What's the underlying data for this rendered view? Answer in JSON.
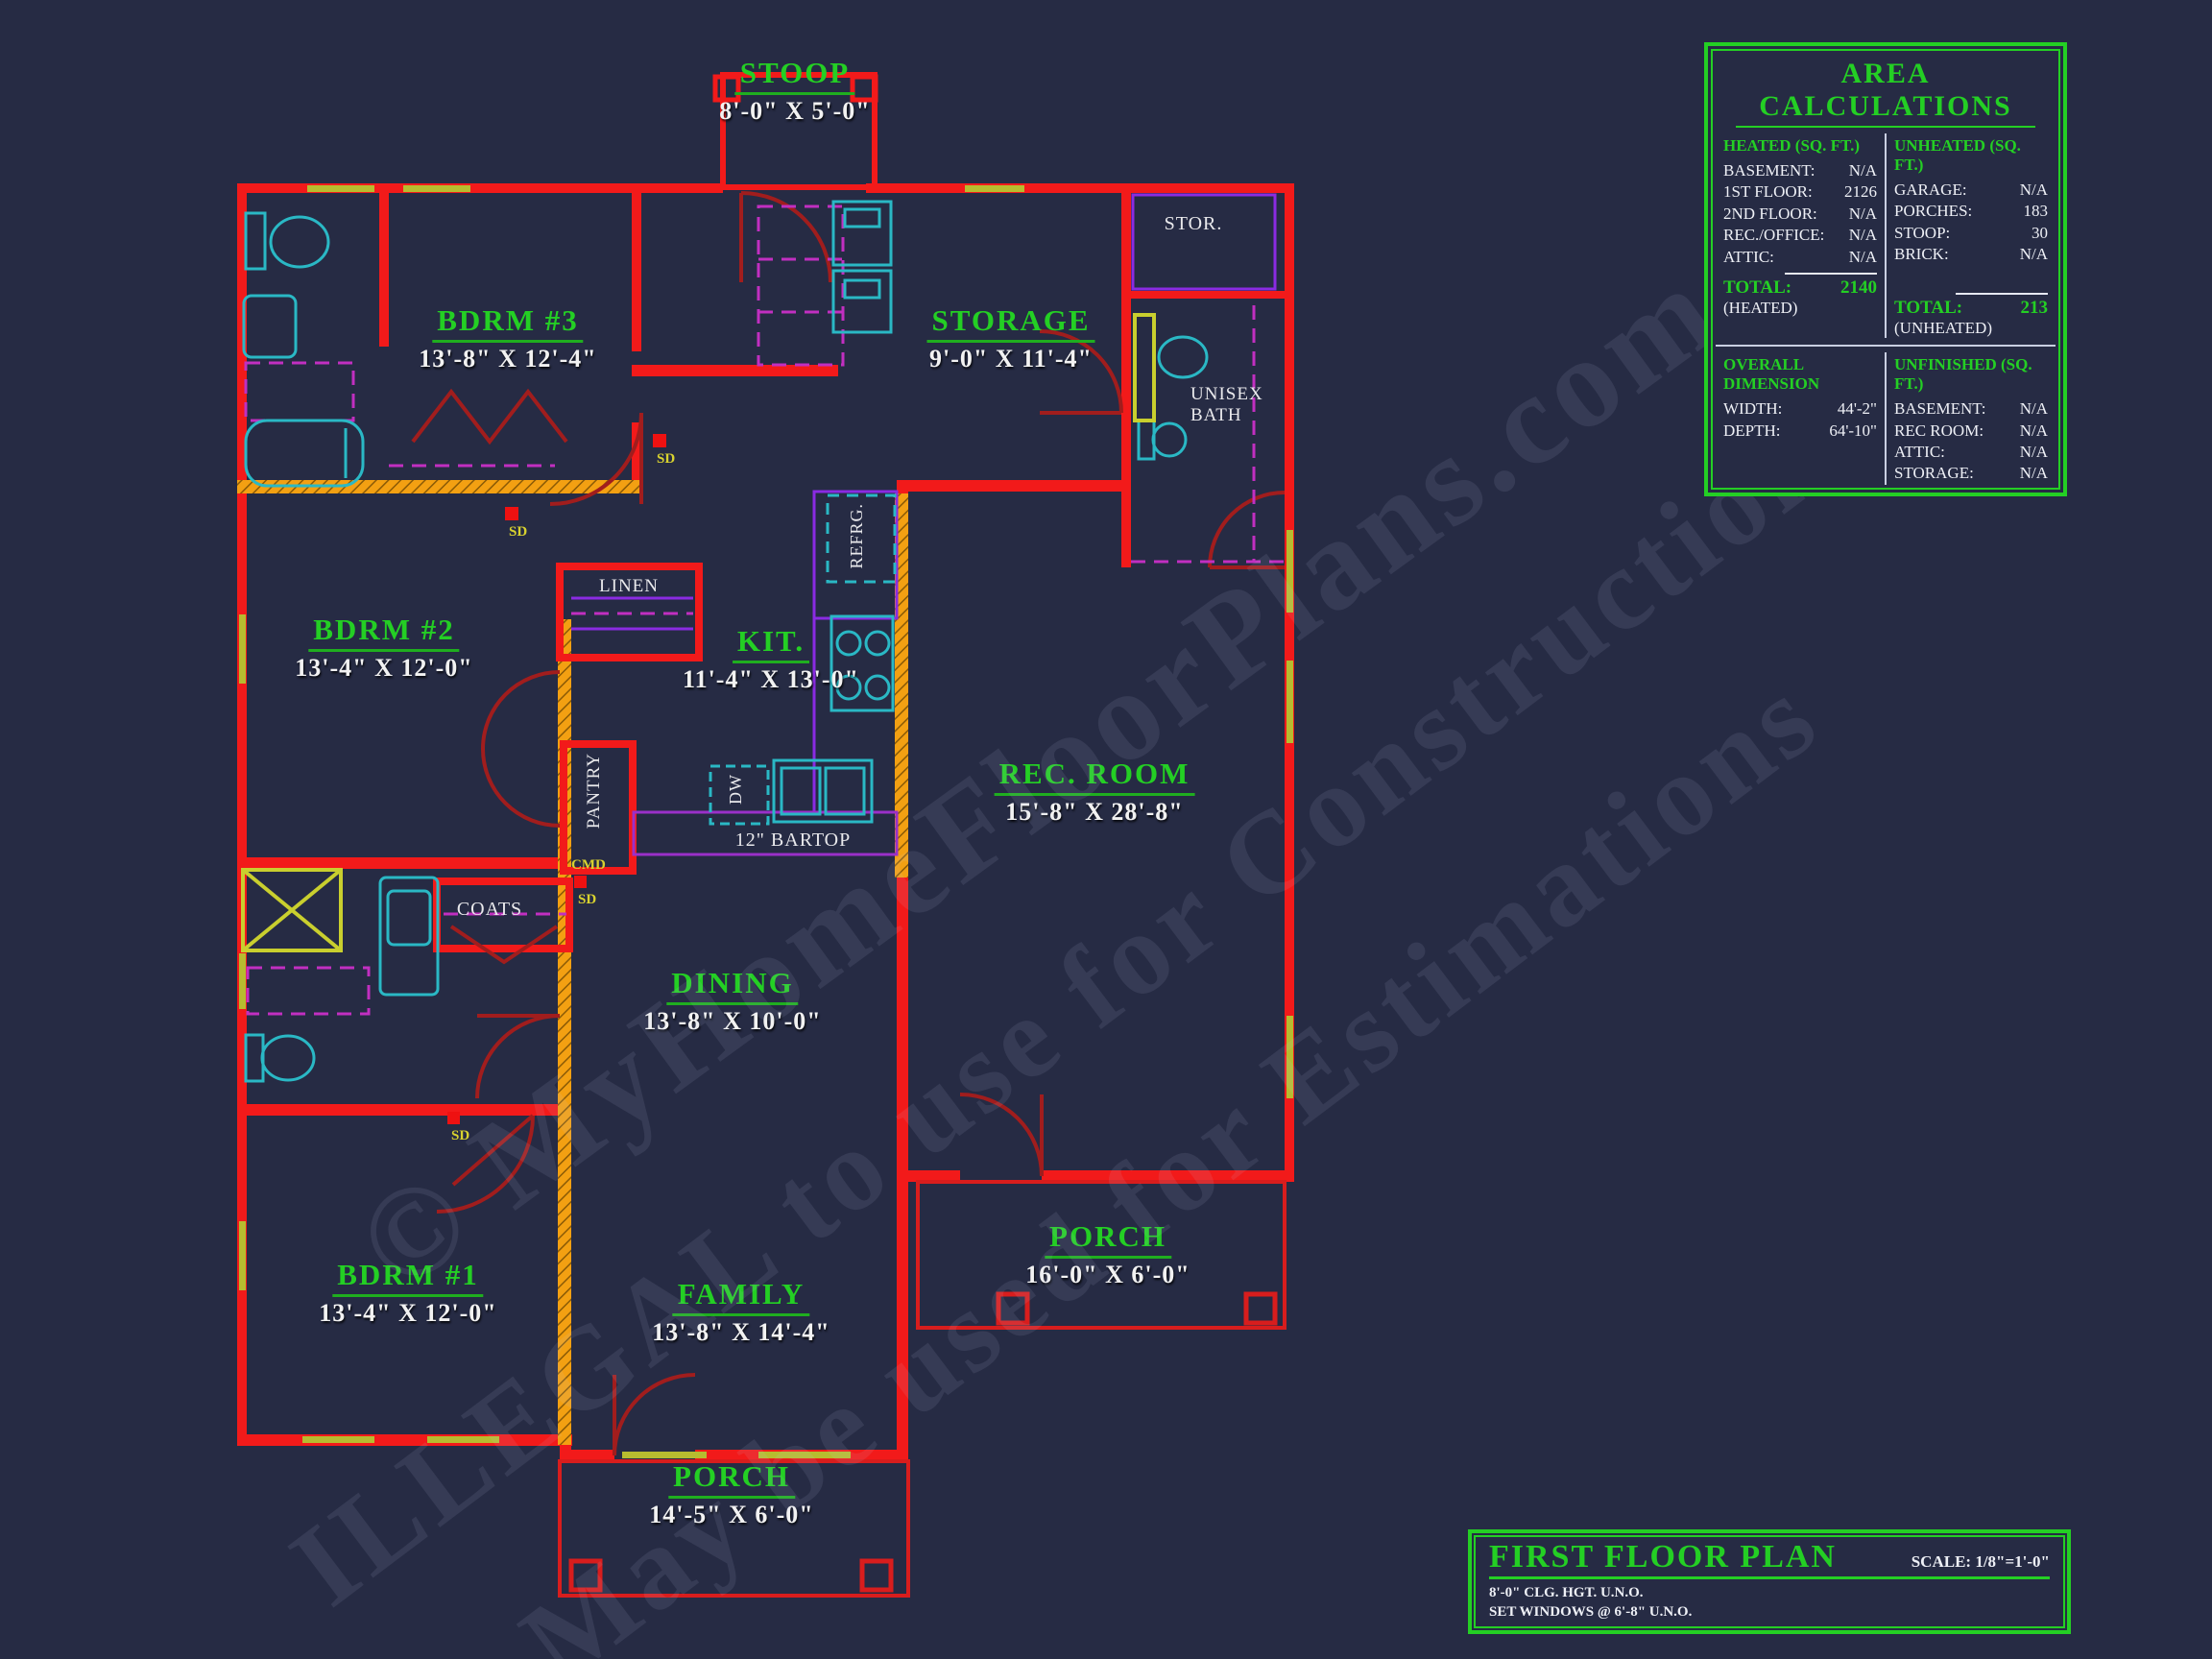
{
  "watermark": {
    "line1": "© MyHomeFloorPlans.com",
    "line2": "ILLEGAL to use for Constructions",
    "line3": "May be used for Estimations"
  },
  "rooms": [
    {
      "name": "STOOP",
      "dims": "8'-0\" X 5'-0\""
    },
    {
      "name": "BDRM #3",
      "dims": "13'-8\" X 12'-4\""
    },
    {
      "name": "STORAGE",
      "dims": "9'-0\" X 11'-4\""
    },
    {
      "name": "BDRM #2",
      "dims": "13'-4\" X 12'-0\""
    },
    {
      "name": "KIT.",
      "dims": "11'-4\" X 13'-0\""
    },
    {
      "name": "REC. ROOM",
      "dims": "15'-8\" X 28'-8\""
    },
    {
      "name": "DINING",
      "dims": "13'-8\" X 10'-0\""
    },
    {
      "name": "BDRM #1",
      "dims": "13'-4\" X 12'-0\""
    },
    {
      "name": "FAMILY",
      "dims": "13'-8\" X 14'-4\""
    },
    {
      "name": "PORCH",
      "dims": "16'-0\" X 6'-0\""
    },
    {
      "name": "PORCH",
      "dims": "14'-5\" X 6'-0\""
    }
  ],
  "tags": {
    "stor": "STOR.",
    "unisex_line1": "UNISEX",
    "unisex_line2": "BATH",
    "linen": "LINEN",
    "pantry": "PANTRY",
    "coats": "COATS",
    "refrg": "REFRG.",
    "dw": "DW",
    "bartop": "12\" BARTOP",
    "cmd": "CMD",
    "sd": "SD"
  },
  "area_calculations": {
    "title": "AREA CALCULATIONS",
    "heated": {
      "header": "HEATED (SQ. FT.)",
      "rows": [
        {
          "label": "BASEMENT:",
          "value": "N/A"
        },
        {
          "label": "1ST FLOOR:",
          "value": "2126"
        },
        {
          "label": "2ND FLOOR:",
          "value": "N/A"
        },
        {
          "label": "REC./OFFICE:",
          "value": "N/A"
        },
        {
          "label": "ATTIC:",
          "value": "N/A"
        }
      ],
      "total_label": "TOTAL:",
      "total_value": "2140",
      "total_sub": "(HEATED)"
    },
    "unheated": {
      "header": "UNHEATED (SQ. FT.)",
      "rows": [
        {
          "label": "GARAGE:",
          "value": "N/A"
        },
        {
          "label": "PORCHES:",
          "value": "183"
        },
        {
          "label": "STOOP:",
          "value": "30"
        },
        {
          "label": "BRICK:",
          "value": "N/A"
        }
      ],
      "total_label": "TOTAL:",
      "total_value": "213",
      "total_sub": "(UNHEATED)"
    },
    "overall_dimension": {
      "header": "OVERALL DIMENSION",
      "rows": [
        {
          "label": "WIDTH:",
          "value": "44'-2\""
        },
        {
          "label": "DEPTH:",
          "value": "64'-10\""
        }
      ]
    },
    "unfinished": {
      "header": "UNFINISHED (SQ. FT.)",
      "rows": [
        {
          "label": "BASEMENT:",
          "value": "N/A"
        },
        {
          "label": "REC ROOM:",
          "value": "N/A"
        },
        {
          "label": "ATTIC:",
          "value": "N/A"
        },
        {
          "label": "STORAGE:",
          "value": "N/A"
        }
      ]
    }
  },
  "title_block": {
    "title": "FIRST FLOOR PLAN",
    "scale": "SCALE: 1/8\"=1'-0\"",
    "note1": "8'-0\" CLG. HGT. U.N.O.",
    "note2": "SET WINDOWS @ 6'-8\" U.N.O."
  }
}
